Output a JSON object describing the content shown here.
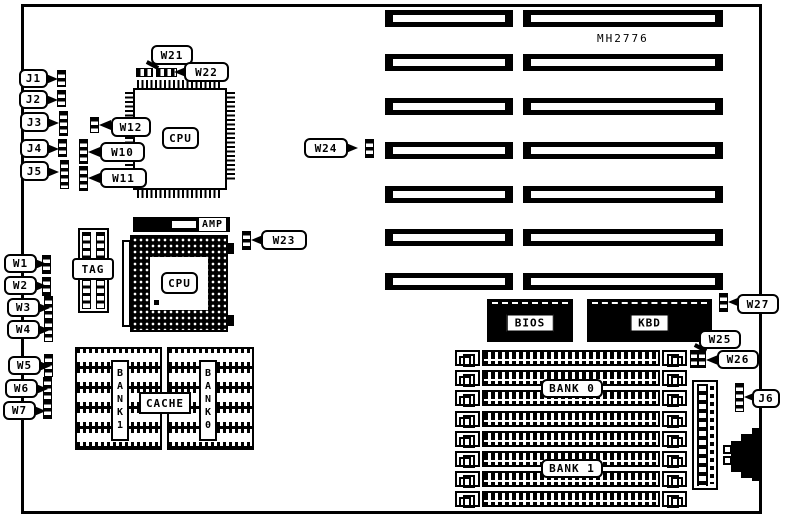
{
  "board": {
    "part_number": "MH2776"
  },
  "colors": {
    "ink": "#000000",
    "paper": "#ffffff"
  },
  "chips": {
    "cpu_qfp": "CPU",
    "cpu_pga": "CPU",
    "amp": "AMP",
    "tag": "TAG",
    "cache": "CACHE",
    "bios": "BIOS",
    "kbd": "KBD"
  },
  "memory": {
    "bank0": "BANK 0",
    "bank1": "BANK 1",
    "cache_bank_left": "BANK1",
    "cache_bank_right": "BANK0"
  },
  "callouts": {
    "j1": "J1",
    "j2": "J2",
    "j3": "J3",
    "j4": "J4",
    "j5": "J5",
    "j6": "J6",
    "w1": "W1",
    "w2": "W2",
    "w3": "W3",
    "w4": "W4",
    "w5": "W5",
    "w6": "W6",
    "w7": "W7",
    "w10": "W10",
    "w11": "W11",
    "w12": "W12",
    "w21": "W21",
    "w22": "W22",
    "w23": "W23",
    "w24": "W24",
    "w25": "W25",
    "w26": "W26",
    "w27": "W27"
  }
}
